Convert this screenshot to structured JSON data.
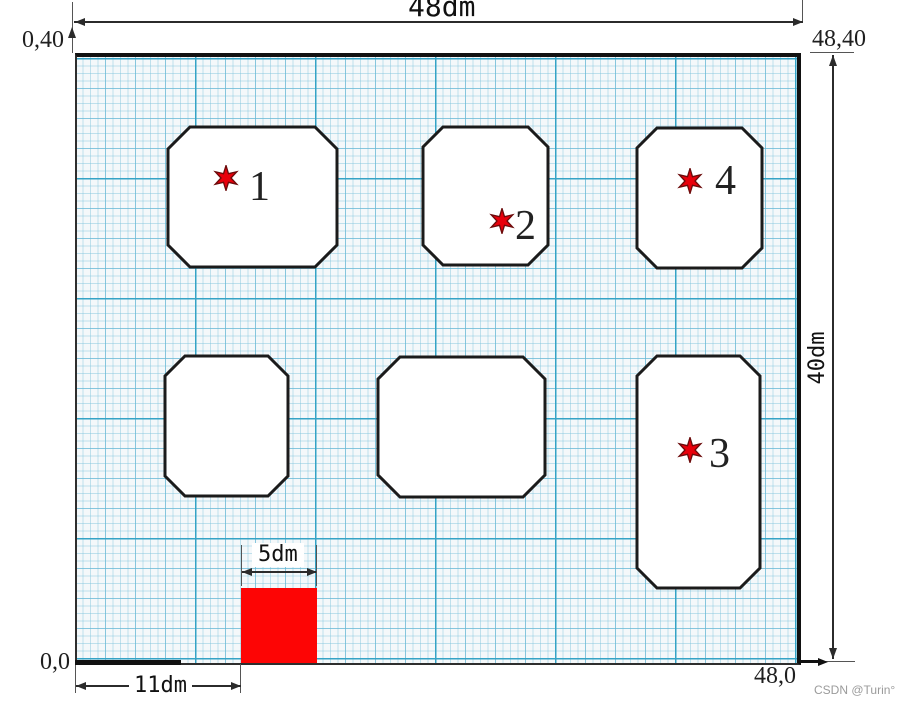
{
  "diagram": {
    "top_dimension": "48dm",
    "right_dimension": "40dm",
    "square_dimension": "5dm",
    "offset_dimension": "11dm",
    "corner_top_left": "0,40",
    "corner_top_right": "48,40",
    "corner_bottom_left": "0,0",
    "corner_bottom_right": "48,0",
    "markers": [
      {
        "label": "1"
      },
      {
        "label": "2"
      },
      {
        "label": "3"
      },
      {
        "label": "4"
      }
    ],
    "watermark": "CSDN @Turin°",
    "colors": {
      "star": "#e8000b",
      "square": "#fd0505",
      "border": "#111111",
      "grid_major": "#34a3c6"
    }
  }
}
